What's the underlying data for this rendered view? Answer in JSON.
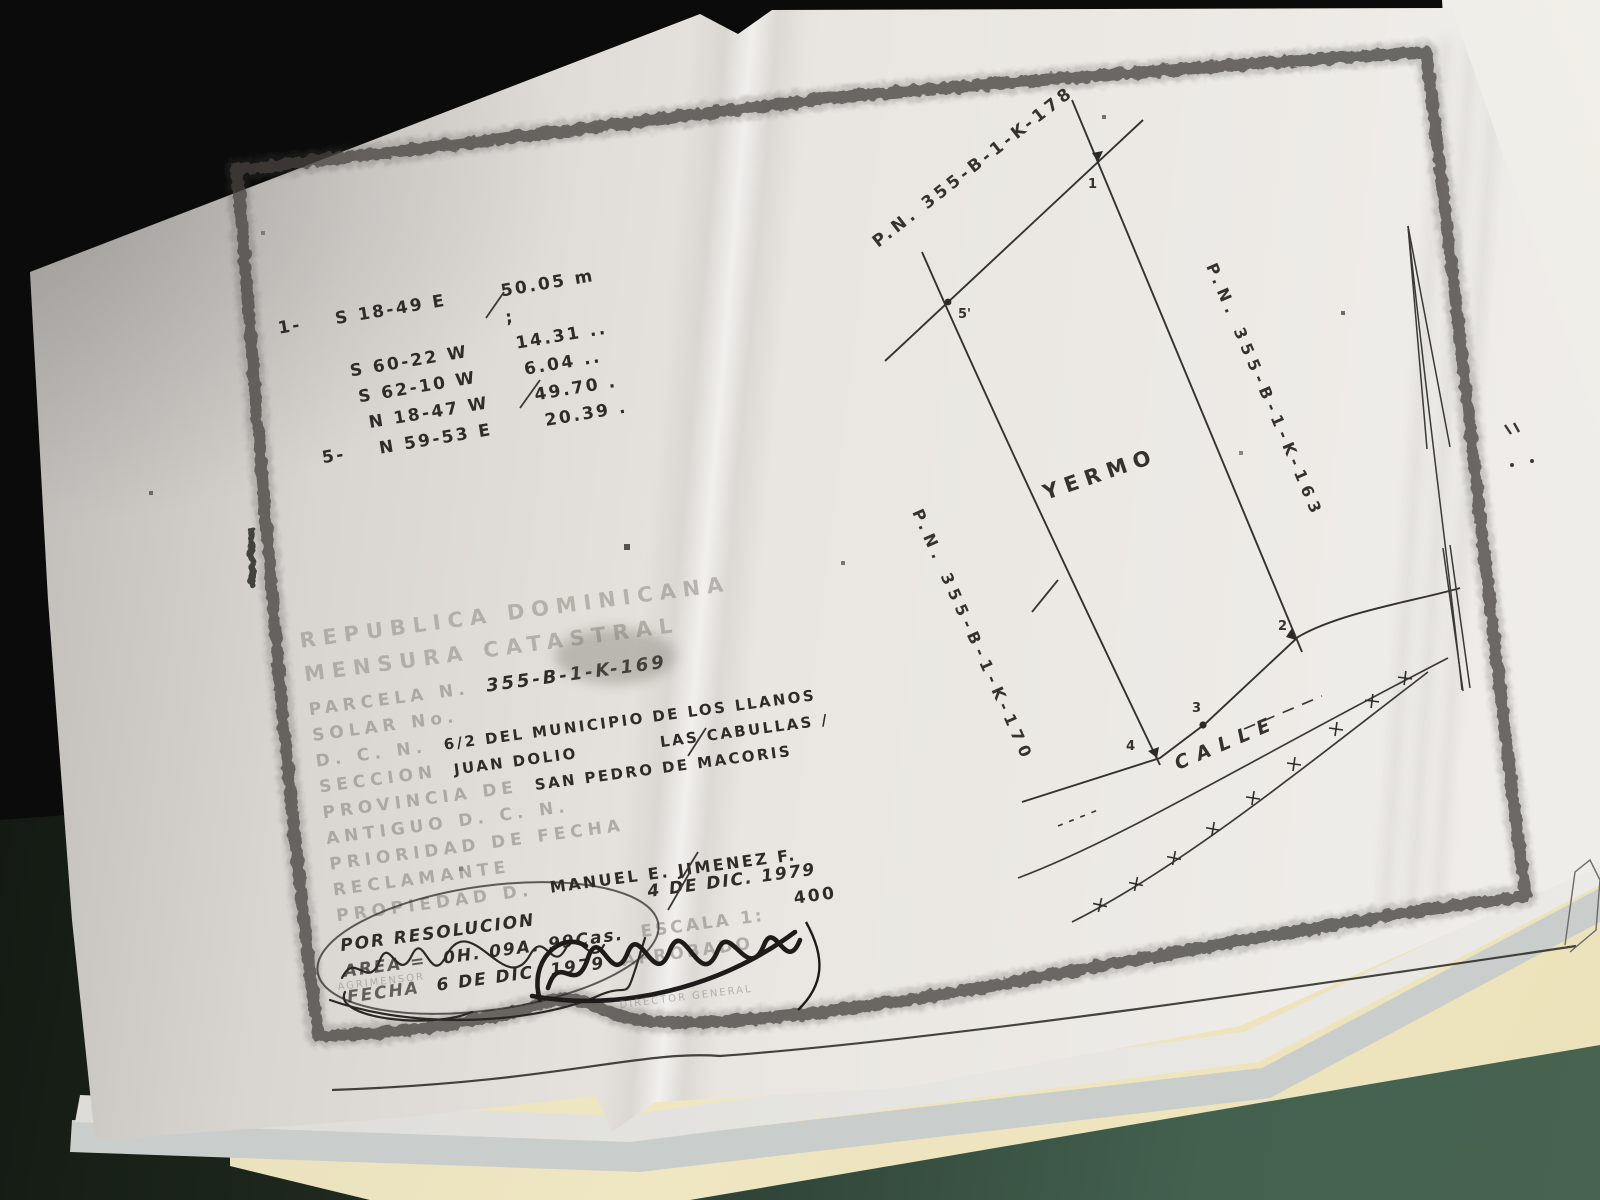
{
  "scene": {
    "desk_color_left": "#1d271d",
    "desk_color_right": "#48634f",
    "folder_color": "#efe6c2",
    "background_sheet": {
      "show_through_text": "NEVER",
      "show_through_sub": "BLURRED"
    }
  },
  "plan": {
    "bearing_table": {
      "rows": [
        {
          "point": "1-",
          "bearing": "S 18-49 E",
          "distance": "50.05 m ;"
        },
        {
          "point": "",
          "bearing": "S 60-22 W",
          "distance": "14.31 .."
        },
        {
          "point": "",
          "bearing": "S 62-10 W",
          "distance": "6.04 .."
        },
        {
          "point": "",
          "bearing": "N 18-47 W",
          "distance": "49.70 ."
        },
        {
          "point": "5-",
          "bearing": "N 59-53 E",
          "distance": "20.39 ."
        }
      ]
    },
    "labels": {
      "parcel_north": "P.N. 355-B-1-K-178",
      "parcel_east": "P.N. 355-B-1-K-163",
      "parcel_west": "P.N. 355-B-1-K-170",
      "interior": "YERMO",
      "street": "CALLE",
      "corner_1": "1",
      "corner_2": "2",
      "corner_3": "3",
      "corner_4": "4",
      "corner_5": "5'"
    },
    "stamp": {
      "line1": "REPUBLICA DOMINICANA",
      "line2": "MENSURA CATASTRAL",
      "parcela_label": "PARCELA N.",
      "parcela_value": "355-B-1-K-169",
      "solar_label": "SOLAR No.",
      "dc_label": "D. C. N.",
      "dc_value": "6/2 DEL MUNICIPIO DE LOS LLANOS",
      "seccion_label": "SECCION",
      "seccion_value": "JUAN DOLIO",
      "paraje_value": "LAS CABULLAS /",
      "provincia_label": "PROVINCIA DE",
      "provincia_value": "SAN PEDRO DE MACORIS",
      "antiguo_label": "ANTIGUO D. C. N.",
      "prioridad_label": "PRIORIDAD DE FECHA",
      "reclamante_label": "RECLAMANTE",
      "propiedad_label": "PROPIEDAD D.",
      "propiedad_value": "MANUEL E. JIMENEZ F.",
      "por_resolucion": "POR RESOLUCION",
      "resolucion_fecha": "4 DE DIC. 1979",
      "area_label": "AREA =",
      "area_value": "0H. 09A. 99Cas.",
      "escala_label": "ESCALA 1:",
      "escala_value": "400",
      "fecha_label": "FECHA",
      "fecha_value": "6 DE DIC. 1979",
      "aprobado_label": "APROBADO",
      "agrimensor_label": "AGRIMENSOR",
      "director_label": "DIRECTOR GENERAL"
    }
  }
}
